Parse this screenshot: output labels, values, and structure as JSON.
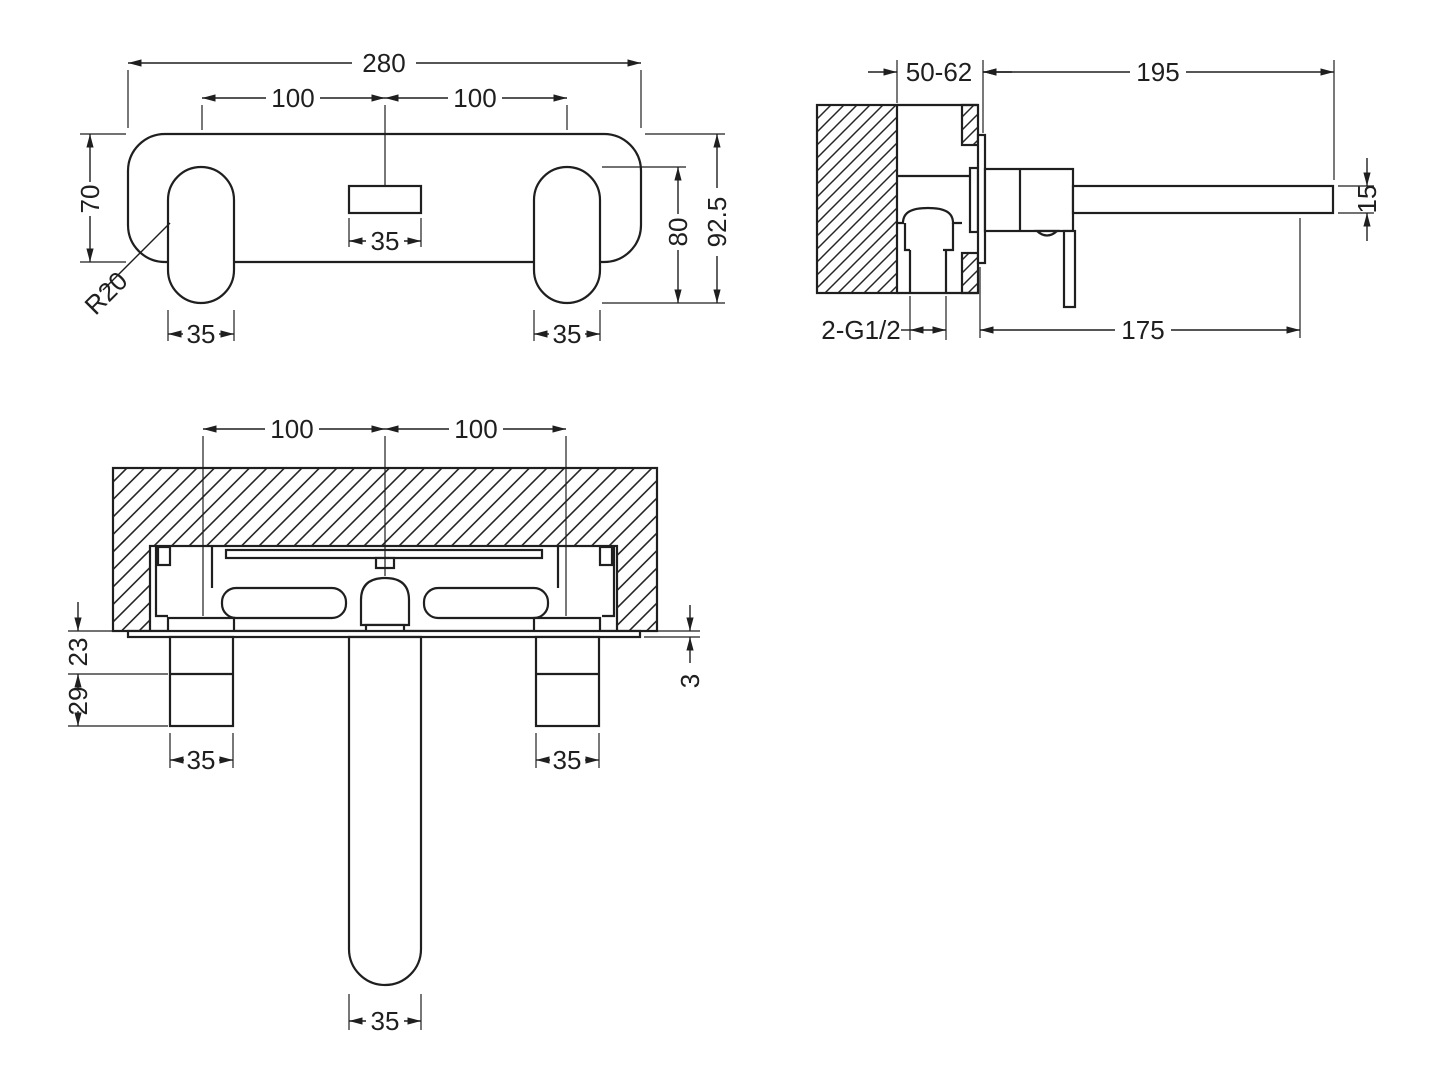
{
  "drawing": {
    "background": "#ffffff",
    "line_color": "#1f1f1f",
    "views": {
      "front": {
        "dims": {
          "overall_width": "280",
          "pitch_left": "100",
          "pitch_right": "100",
          "plate_height": "70",
          "spout_hole_width": "35",
          "handle_opening_height": "80",
          "overall_height": "92.5",
          "handle_width_left": "35",
          "handle_width_right": "35",
          "corner_radius": "R20"
        }
      },
      "side": {
        "dims": {
          "wall_depth_range": "50-62",
          "spout_reach": "195",
          "spout_thickness": "15",
          "inlet_thread": "2-G1/2",
          "spout_reach_lower": "175"
        }
      },
      "section": {
        "dims": {
          "pitch_left": "100",
          "pitch_right": "100",
          "handle_base_depth": "23",
          "handle_grip_depth": "29",
          "plate_thickness": "3",
          "handle_width_left": "35",
          "spout_width": "35",
          "handle_width_right": "35"
        }
      }
    }
  }
}
